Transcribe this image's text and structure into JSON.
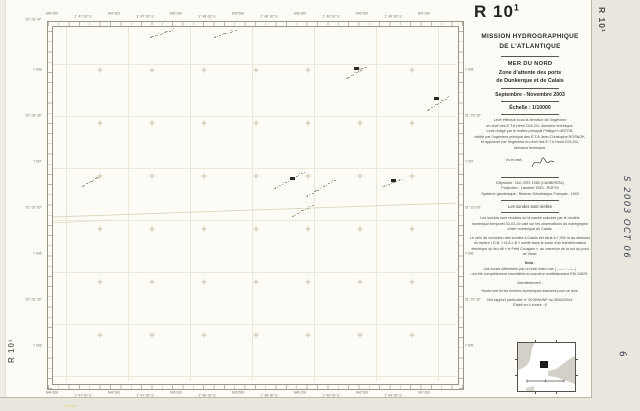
{
  "sheet": {
    "id_main": "R 10",
    "id_sup": "1",
    "id_full": "R 10¹"
  },
  "margins": {
    "right_top_label": "R 10¹",
    "bottom_left_label": "R 10¹",
    "handwritten_ref": "S 2003 OCT 06",
    "handwritten_sheet_number": "6"
  },
  "title_block": {
    "org_line1": "MISSION HYDROGRAPHIQUE",
    "org_line2": "DE L'ATLANTIQUE",
    "region": "MER DU NORD",
    "subject_line1": "Zone d'attente des ports",
    "subject_line2": "de Dunkerque et de Calais",
    "period": "Septembre - Novembre 2003",
    "scale": "Échelle : 1/10000",
    "credits": [
      "Levé effectué sous la direction de l'ingénieur",
      "en chef des E.T.A Henri DOLOU, directeur technique.",
      "Levé rédigé par le maître principal Philippe LURTON,",
      "vérifié par l'ingénieur principal des E.T.A Jean-Christophe ROSNOK,",
      "et approuvé par l'ingénieur en chef des E.T.A Henri DOLOU,",
      "directeur technique."
    ],
    "visa": "Vu et visé,",
    "geodesy": [
      "Ellipsoïde : IAG GRS 1980 (CANBERRA)",
      "Projection : Lambert 1993 - RGF93",
      "Système géodésique : Réseau Géodésique Français : 1993"
    ],
    "soundings_heading": "Les sondes sont réelles",
    "tide_note": [
      "Les sondes sont réduites de la marée calculée par le modèle",
      "numérique temporel 03-03-19 calé sur les observations du marégraphe",
      "côtier numérique de Calais."
    ],
    "datum_note": [
      "Le zéro de réduction des sondes à Calais est situé à 7,092 m au-dessous",
      "du repère I.G.N. « N.A.L.B » scellé dans le socle d'un transformateur",
      "électrique du feu dit « le Petit Courgain », au carrefour de la rue du pont",
      "de Vivier."
    ],
    "nota_label": "Nota :",
    "nota_lines": [
      "Les zones délimitées par un trait mixte noir ( ——··—— )",
      "ont été complètement insonifiées au sondeur multifaisceaux EM 1002S."
    ],
    "warning_label": "Avertissement :",
    "validity": "Seuls font foi les fichiers numériques élaborés pour ce levé.",
    "report": "Voir rapport particulier n° 00 MHA/NP du 06/04/2004.",
    "edition": "Établi en 4 zones : 6"
  },
  "map": {
    "corner_label": "51° 03' 47\"",
    "top_labels": [
      "644 000",
      "1° 47' 00\" E",
      "644 500",
      "1° 47' 30\" E",
      "645 000",
      "1° 48' 00\" E",
      "645 500",
      "1° 48' 30\" E",
      "646 000",
      "1° 49' 00\" E",
      "646 500",
      "1° 49' 30\" E",
      "647 000"
    ],
    "bottom_labels": [
      "644 000",
      "1° 47' 00\" E",
      "644 500",
      "1° 47' 30\" E",
      "645 000",
      "1° 48' 00\" E",
      "645 500",
      "1° 48' 30\" E",
      "646 000",
      "1° 49' 00\" E",
      "646 500",
      "1° 49' 30\" E",
      "647 000"
    ],
    "left_labels": [
      "7 098",
      "51° 03' 30\"",
      "7 097",
      "51° 03' 00\"",
      "7 096",
      "51° 02' 30\"",
      "7 095"
    ],
    "right_labels": [
      "7 098",
      "51° 03' 30\"",
      "7 097",
      "51° 03' 00\"",
      "7 096",
      "51° 02' 30\"",
      "7 095"
    ],
    "soundings_clusters": [
      {
        "x": 97,
        "y": 10,
        "n": 10,
        "dx": 2.4,
        "dy": -0.8
      },
      {
        "x": 161,
        "y": 10,
        "n": 9,
        "dx": 2.6,
        "dy": -0.9
      },
      {
        "x": 293,
        "y": 51,
        "n": 9,
        "dx": 2.4,
        "dy": -1.4
      },
      {
        "x": 374,
        "y": 83,
        "n": 10,
        "dx": 2.2,
        "dy": -1.4
      },
      {
        "x": 221,
        "y": 161,
        "n": 12,
        "dx": 2.7,
        "dy": -1.5
      },
      {
        "x": 253,
        "y": 169,
        "n": 11,
        "dx": 2.8,
        "dy": -1.6
      },
      {
        "x": 239,
        "y": 189,
        "n": 9,
        "dx": 2.5,
        "dy": -1.4
      },
      {
        "x": 330,
        "y": 159,
        "n": 8,
        "dx": 2.5,
        "dy": -1.0
      },
      {
        "x": 29,
        "y": 159,
        "n": 8,
        "dx": 2.2,
        "dy": -1.3
      }
    ],
    "marks": [
      {
        "x": 301,
        "y": 40
      },
      {
        "x": 237,
        "y": 150
      },
      {
        "x": 338,
        "y": 152
      },
      {
        "x": 381,
        "y": 70
      }
    ]
  },
  "colors": {
    "paper": "#fcfbf6",
    "frame": "#9b9585",
    "ink": "#2e2c28",
    "faint_label": "#76715f",
    "grid": "#e9e5d4",
    "handwriting": "#3f4450"
  }
}
